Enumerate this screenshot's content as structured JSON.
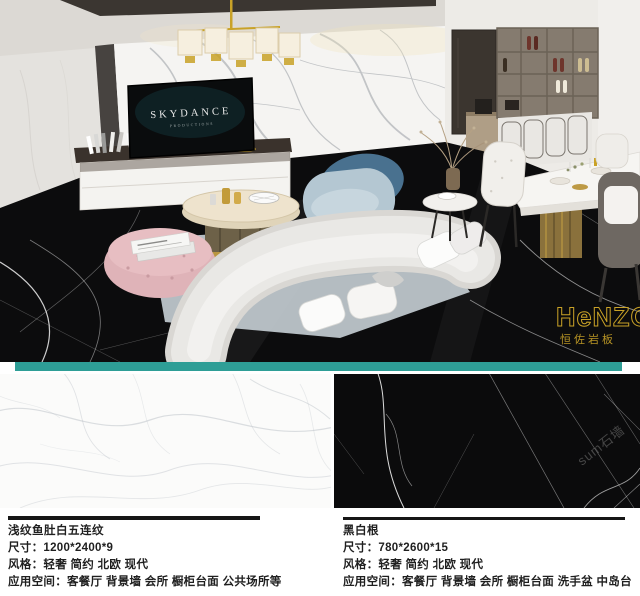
{
  "scene": {
    "tv_brand": "SKYDANCE",
    "tv_sub": "PRODUCTIONS"
  },
  "brand": {
    "logo_text": "HeNZO",
    "logo_subtext": "恒佐岩板"
  },
  "watermark": {
    "text": "sum石墙"
  },
  "colors": {
    "divider_teal": "#2E9E96",
    "logo_gold": "#C9A227",
    "floor_black": "#0B0B0C",
    "text": "#1F1F1F"
  },
  "products": [
    {
      "name": "浅纹鱼肚白五连纹",
      "size_line": "尺寸：1200*2400*9",
      "style_line": "风格：轻奢 简约 北欧 现代",
      "space_line": "应用空间：客餐厅 背景墙 会所 橱柜台面 公共场所等"
    },
    {
      "name": "黑白根",
      "size_line": "尺寸：780*2600*15",
      "style_line": "风格：轻奢 简约 北欧 现代",
      "space_line": "应用空间：客餐厅 背景墙 会所 橱柜台面 洗手盆 中岛台"
    }
  ]
}
